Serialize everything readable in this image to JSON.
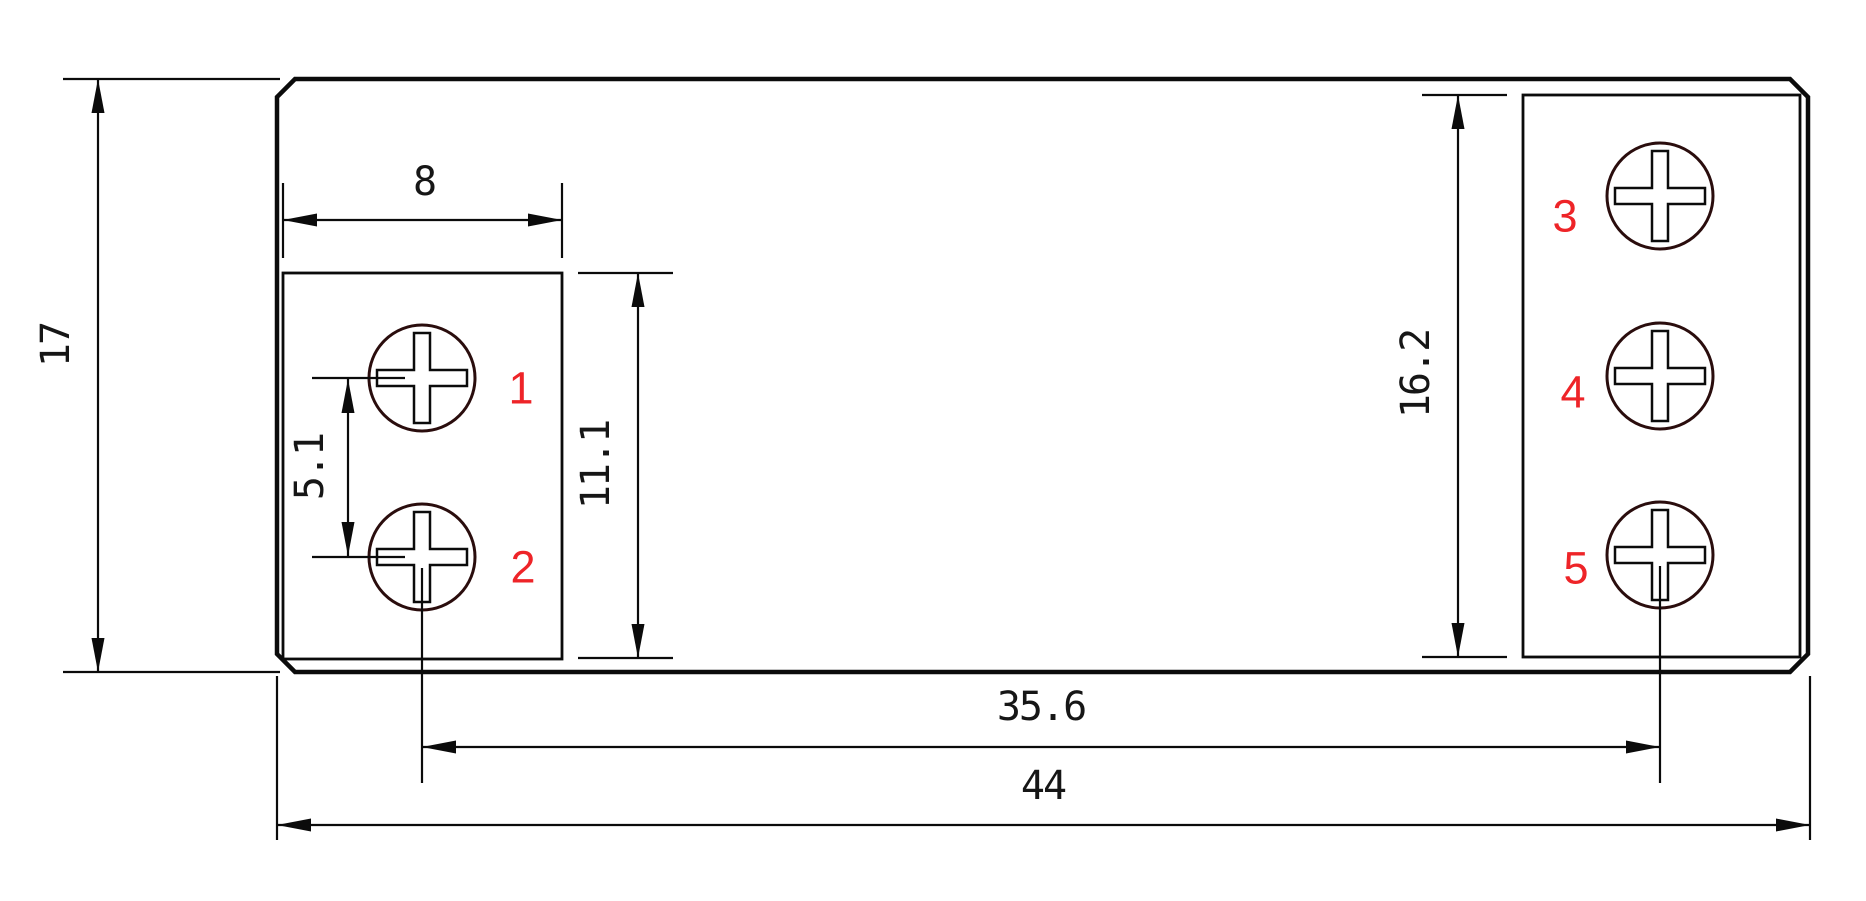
{
  "page": {
    "background": "#ffffff"
  },
  "drawing": {
    "type": "technical-dimension-drawing",
    "subject": "5-terminal relay footprint top view",
    "line_color": "#0b0b0b",
    "accent_red": "#ee2428",
    "dimensions": {
      "overall_height": {
        "label": "17",
        "orientation": "vertical"
      },
      "pad_width": {
        "label": "8",
        "orientation": "horizontal"
      },
      "screw_pitch": {
        "label": "5.1",
        "orientation": "vertical"
      },
      "left_pad_height": {
        "label": "11.1",
        "orientation": "vertical"
      },
      "right_pad_height": {
        "label": "16.2",
        "orientation": "vertical"
      },
      "screw_span": {
        "label": "35.6",
        "orientation": "horizontal"
      },
      "overall_width": {
        "label": "44",
        "orientation": "horizontal"
      }
    },
    "terminals": [
      {
        "number": "1"
      },
      {
        "number": "2"
      },
      {
        "number": "3"
      },
      {
        "number": "4"
      },
      {
        "number": "5"
      }
    ]
  }
}
